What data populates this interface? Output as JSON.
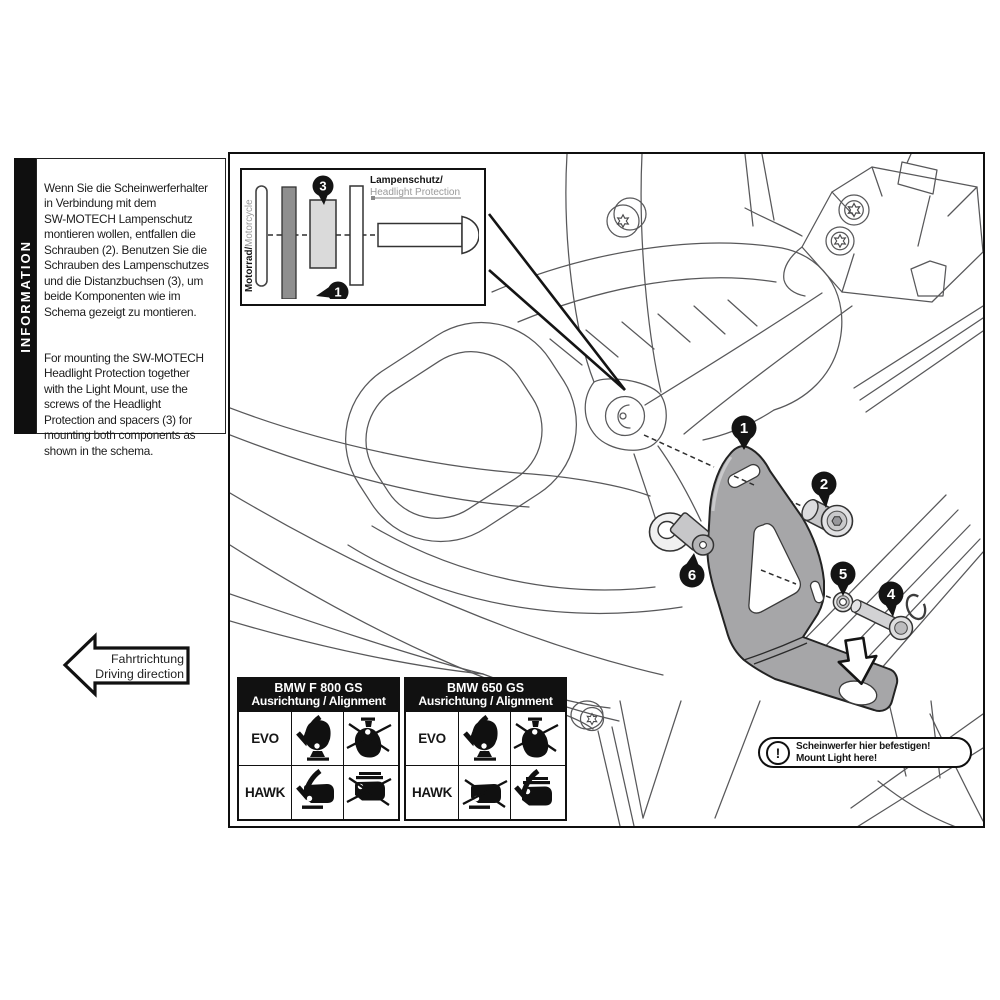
{
  "info_panel": {
    "label": "INFORMATION",
    "paragraph_de": "Wenn Sie die Scheinwerferhalter\nin Verbindung mit dem\nSW-MOTECH Lampenschutz\nmontieren wollen, entfallen die\nSchrauben (2). Benutzen Sie die\nSchrauben des Lampenschutzes\nund die Distanzbuchsen (3), um\nbeide Komponenten wie im\nSchema gezeigt zu montieren.",
    "paragraph_en": "For mounting the SW-MOTECH\nHeadlight Protection together\nwith the Light Mount, use the\nscrews of the Headlight\nProtection and spacers (3) for\nmounting both components as\nshown in the schema."
  },
  "inset": {
    "motorcycle_label": "Motorrad/",
    "motorcycle_label_en": "Motorcycle",
    "protection_label": "Lampenschutz/",
    "protection_label_en": "Headlight Protection",
    "callout_spacer": "3",
    "callout_mount": "1"
  },
  "diagram": {
    "callouts": {
      "mount": "1",
      "screw_top": "2",
      "screw_bottom": "4",
      "washer": "5",
      "spacer_bushing": "6"
    }
  },
  "direction_arrow": {
    "line_de": "Fahrtrichtung",
    "line_en": "Driving direction"
  },
  "warning_note": {
    "symbol": "!",
    "line_de": "Scheinwerfer hier befestigen!",
    "line_en": "Mount Light here!"
  },
  "alignment_tables": [
    {
      "title_line1": "BMW F 800 GS",
      "title_line2": "Ausrichtung / Alignment",
      "rows": [
        {
          "label": "EVO",
          "cells": [
            {
              "icon": "headlight-upright",
              "allowed": true
            },
            {
              "icon": "headlight-hanging",
              "allowed": false
            }
          ]
        },
        {
          "label": "HAWK",
          "cells": [
            {
              "icon": "headlight-upright",
              "allowed": true
            },
            {
              "icon": "headlight-hanging",
              "allowed": false
            }
          ]
        }
      ]
    },
    {
      "title_line1": "BMW 650 GS",
      "title_line2": "Ausrichtung / Alignment",
      "rows": [
        {
          "label": "EVO",
          "cells": [
            {
              "icon": "headlight-upright",
              "allowed": true
            },
            {
              "icon": "headlight-hanging",
              "allowed": false
            }
          ]
        },
        {
          "label": "HAWK",
          "cells": [
            {
              "icon": "headlight-upright",
              "allowed": false
            },
            {
              "icon": "headlight-hanging",
              "allowed": true
            }
          ]
        }
      ]
    }
  ],
  "colors": {
    "ink": "#111111",
    "line_art": "#58585a",
    "bracket_fill": "#a6a6a8",
    "spacer_fill": "#dadada",
    "mount_bar_fill": "#8f8f8f",
    "muted_text": "#9a9a9a"
  }
}
